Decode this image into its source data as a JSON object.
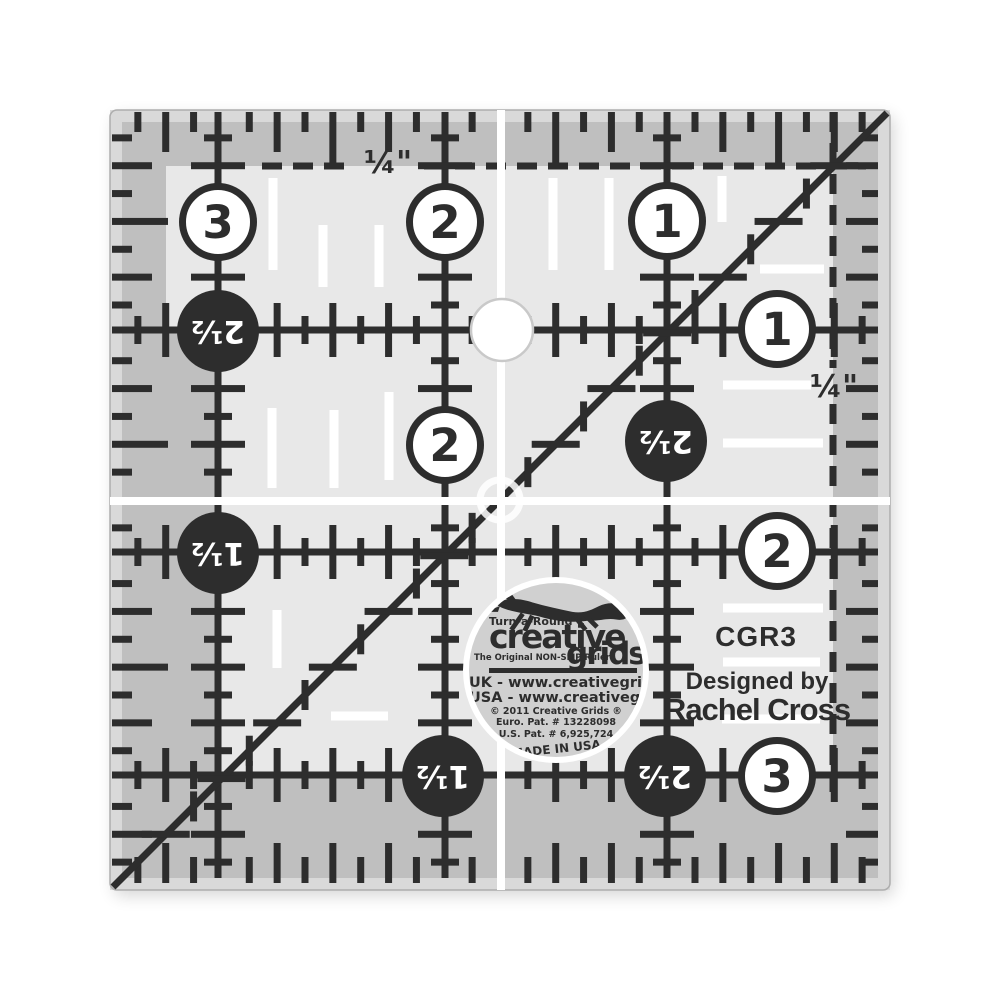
{
  "ruler": {
    "model_code": "CGR3",
    "designed_by_label": "Designed by",
    "designer_name": "Rachel Cross",
    "quarter_label_top": "¼\"",
    "quarter_label_right": "¼\"",
    "white_circles": [
      {
        "value": "3",
        "x": 218,
        "y": 222
      },
      {
        "value": "2",
        "x": 445,
        "y": 222
      },
      {
        "value": "1",
        "x": 667,
        "y": 221
      },
      {
        "value": "1",
        "x": 777,
        "y": 329
      },
      {
        "value": "2",
        "x": 445,
        "y": 445
      },
      {
        "value": "2",
        "x": 777,
        "y": 551
      },
      {
        "value": "3",
        "x": 777,
        "y": 776
      }
    ],
    "black_circles": [
      {
        "value": "2½",
        "x": 218,
        "y": 331
      },
      {
        "value": "1½",
        "x": 218,
        "y": 553
      },
      {
        "value": "2½",
        "x": 666,
        "y": 441
      },
      {
        "value": "1½",
        "x": 443,
        "y": 776
      },
      {
        "value": "2½",
        "x": 665,
        "y": 776
      }
    ]
  },
  "logo": {
    "trademark_line": "Turn-a-Round™",
    "brand_word_1": "creative",
    "brand_word_2": "grids®",
    "tagline": "The Original NON-SLIP Ruler",
    "uk_website": "UK - www.creativegrids.com",
    "usa_website": "USA - www.creativegridsusa.com",
    "copyright_line": "© 2011 Creative Grids ®",
    "euro_patent": "Euro. Pat. # 13228098",
    "us_patent": "U.S. Pat. # 6,925,724",
    "made_in": "MADE IN USA",
    "fox_icon": "leaping-fox-icon"
  },
  "colors": {
    "ink": "#2d2d2d",
    "ruler_inner": "#e8e8e8",
    "ruler_band": "#bfbfbf",
    "ruler_edge_strip": "#d9d9d9",
    "logo_fill": "#d0d0d0",
    "background": "#ffffff"
  }
}
